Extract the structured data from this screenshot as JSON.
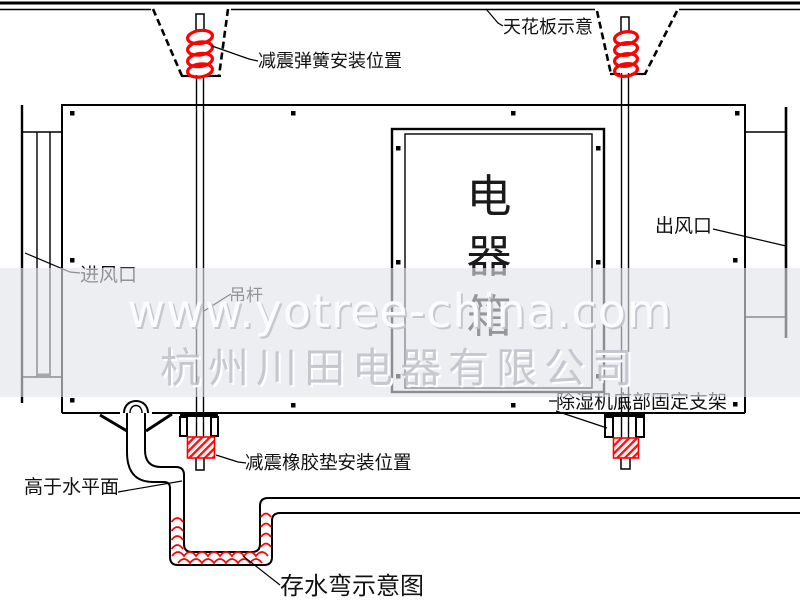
{
  "diagram": {
    "labels": {
      "ceiling": "天花板示意",
      "spring_position": "减震弹簧安装位置",
      "air_inlet": "进风口",
      "hanging_rod": "吊杆",
      "air_outlet": "出风口",
      "bottom_bracket": "除湿机底部固定支架",
      "rubber_pad_position": "减震橡胶垫安装位置",
      "above_water_level": "高于水平面",
      "water_trap": "存水弯示意图"
    },
    "electric_box_chars": [
      "电",
      "器",
      "箱"
    ],
    "watermark": {
      "url": "www.yotree-china.com",
      "company": "杭州川田电器有限公司"
    },
    "colors": {
      "line": "#000000",
      "highlight": "#ff0000",
      "watermark_band": "#e2e3e9"
    }
  }
}
